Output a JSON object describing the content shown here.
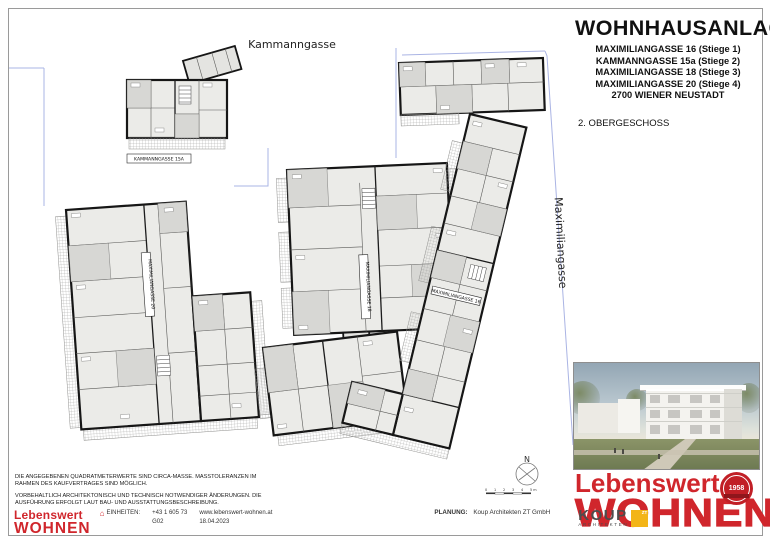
{
  "title_block": {
    "title": "WOHNHAUSANLAGE",
    "address_lines": [
      "MAXIMILIANGASSE 16 (Stiege 1)",
      "KAMMANNGASSE 15a (Stiege 2)",
      "MAXIMILIANGASSE 18 (Stiege 3)",
      "MAXIMILIANGASSE 20 (Stiege 4)"
    ],
    "city": "2700 WIENER NEUSTADT",
    "floor_label": "2. OBERGESCHOSS"
  },
  "streets": {
    "top": "Kammanngasse",
    "right": "Maximiliangasse"
  },
  "plan": {
    "building_labels": {
      "stiege2": "KAMMANNGASSE 15A",
      "stiege4": "MAXIMILIANGASSE 20",
      "stiege3": "MAXIMILIANGASSE 18",
      "stiege1": "MAXIMILIANGASSE 16"
    },
    "north_label": "N",
    "scale_ticks": [
      "0",
      "1",
      "2",
      "3",
      "4",
      "5 m"
    ]
  },
  "disclaimer": {
    "para1": "DIE ANGEGEBENEN QUADRATMETERWERTE SIND CIRCA-MASSE. MASSTOLERANZEN IM RAHMEN DES KAUFVERTRAGES SIND MÖGLICH.",
    "para2": "VORBEHALTLICH ARCHITEKTONISCH UND TECHNISCH NOTWENDIGER ÄNDERUNGEN. DIE AUSFÜHRUNG ERFOLGT LAUT BAU- UND AUSSTATTUNGSBESCHREIBUNG."
  },
  "footer": {
    "logo_line1": "Lebenswert",
    "logo_line2": "WOHNEN",
    "einheiten_label": "EINHEITEN:",
    "phone": "+43 1 605 73",
    "unit_code": "G02",
    "website": "www.lebenswert-wohnen.at",
    "date": "18.04.2023",
    "planung_label": "PLANUNG:",
    "planung_value": "Koup Architekten ZT GmbH",
    "koup_name": "KOUP",
    "koup_sub": "ARCHITEKTEN",
    "koup_square_mark": "ZT"
  },
  "brand": {
    "logo_line1": "Lebenswert",
    "logo_line2": "WOHNEN",
    "seal_year": "1958",
    "accent_red": "#d0262c",
    "koup_yellow": "#f3b517"
  }
}
